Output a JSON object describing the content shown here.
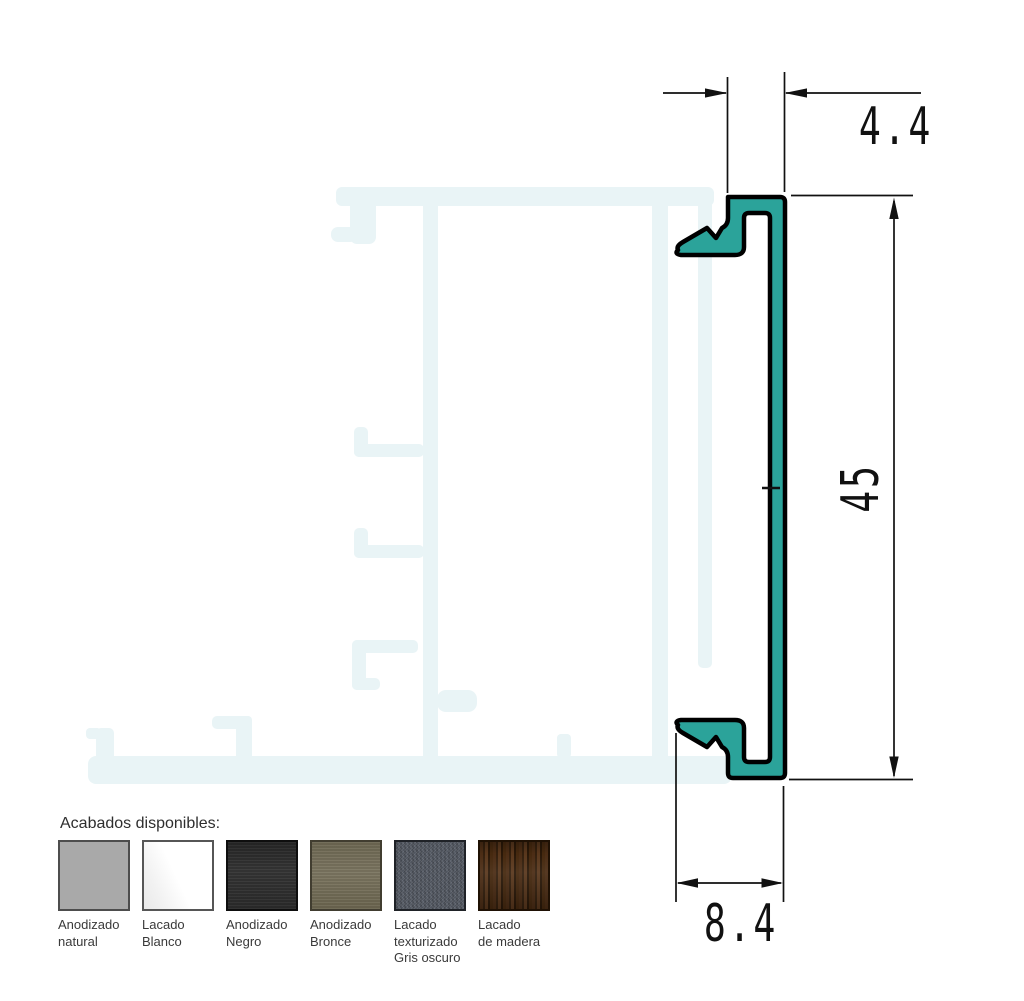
{
  "drawing": {
    "dims": {
      "top_width": "4.4",
      "height": "45",
      "bottom_width": "8.4"
    },
    "profile_fill": "#2BA39A",
    "outline_color": "#000000",
    "watermark_fill": "#E9F4F6",
    "dimension_line_color": "#111111"
  },
  "finishes": {
    "heading": "Acabados disponibles:",
    "items": [
      {
        "id": "anodizado-natural",
        "lines": [
          "Anodizado",
          "natural",
          ""
        ],
        "color": "#a9a9a9"
      },
      {
        "id": "lacado-blanco",
        "lines": [
          "Lacado",
          "Blanco",
          ""
        ],
        "color": "#ffffff"
      },
      {
        "id": "anodizado-negro",
        "lines": [
          "Anodizado",
          "Negro",
          ""
        ],
        "color": "#2f2f2f"
      },
      {
        "id": "anodizado-bronce",
        "lines": [
          "Anodizado",
          "Bronce",
          ""
        ],
        "color": "#756f5a"
      },
      {
        "id": "lacado-texturizado-gris-oscuro",
        "lines": [
          "Lacado",
          "texturizado",
          "Gris oscuro"
        ],
        "color": "#575c65"
      },
      {
        "id": "lacado-de-madera",
        "lines": [
          "Lacado",
          "de madera",
          ""
        ],
        "color": "#452a12"
      }
    ]
  }
}
